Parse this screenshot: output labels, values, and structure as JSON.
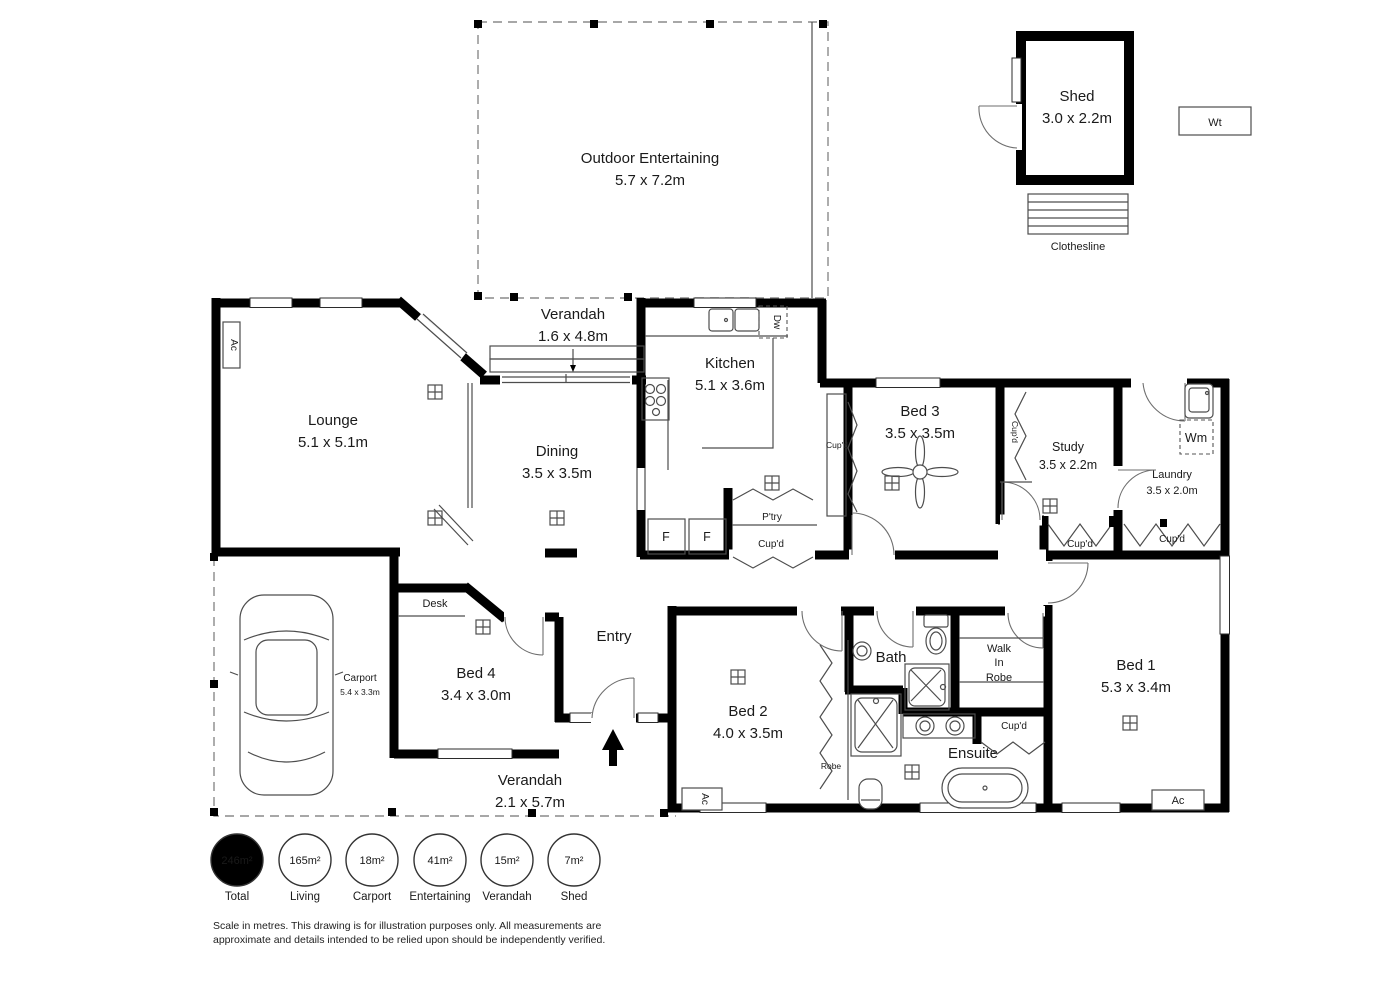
{
  "rooms": {
    "outdoor": {
      "name": "Outdoor Entertaining",
      "dims": "5.7 x 7.2m"
    },
    "shed": {
      "name": "Shed",
      "dims": "3.0 x 2.2m"
    },
    "verandah_top": {
      "name": "Verandah",
      "dims": "1.6 x 4.8m"
    },
    "lounge": {
      "name": "Lounge",
      "dims": "5.1 x 5.1m"
    },
    "dining": {
      "name": "Dining",
      "dims": "3.5 x 3.5m"
    },
    "kitchen": {
      "name": "Kitchen",
      "dims": "5.1 x 3.6m"
    },
    "bed3": {
      "name": "Bed 3",
      "dims": "3.5 x 3.5m"
    },
    "study": {
      "name": "Study",
      "dims": "3.5 x 2.2m"
    },
    "laundry": {
      "name": "Laundry",
      "dims": "3.5 x 2.0m"
    },
    "carport": {
      "name": "Carport",
      "dims": "5.4 x 3.3m"
    },
    "bed4": {
      "name": "Bed 4",
      "dims": "3.4 x 3.0m"
    },
    "entry": {
      "name": "Entry"
    },
    "verandah_bottom": {
      "name": "Verandah",
      "dims": "2.1 x 5.7m"
    },
    "bed2": {
      "name": "Bed 2",
      "dims": "4.0 x 3.5m"
    },
    "bath": {
      "name": "Bath"
    },
    "wir": {
      "l1": "Walk",
      "l2": "In",
      "l3": "Robe"
    },
    "bed1": {
      "name": "Bed 1",
      "dims": "5.3 x 3.4m"
    },
    "ensuite": {
      "name": "Ensuite"
    }
  },
  "labels": {
    "wt": "Wt",
    "clothesline": "Clothesline",
    "dw": "Dw",
    "fridge": "F",
    "pantry": "P'try",
    "cupd": "Cup'd",
    "wm": "Wm",
    "desk": "Desk",
    "robe": "Robe",
    "ac": "Ac"
  },
  "badges": [
    {
      "value": "246m²",
      "label": "Total",
      "filled": true
    },
    {
      "value": "165m²",
      "label": "Living",
      "filled": false
    },
    {
      "value": "18m²",
      "label": "Carport",
      "filled": false
    },
    {
      "value": "41m²",
      "label": "Entertaining",
      "filled": false
    },
    {
      "value": "15m²",
      "label": "Verandah",
      "filled": false
    },
    {
      "value": "7m²",
      "label": "Shed",
      "filled": false
    }
  ],
  "disclaimer": {
    "line1": "Scale in metres. This drawing is for illustration purposes only. All measurements are",
    "line2": "approximate and details intended to be relied upon should be independently verified."
  },
  "colors": {
    "wall": "#000000",
    "thin": "#4d4d4d",
    "dash": "#8a8a8a",
    "background": "#ffffff"
  }
}
